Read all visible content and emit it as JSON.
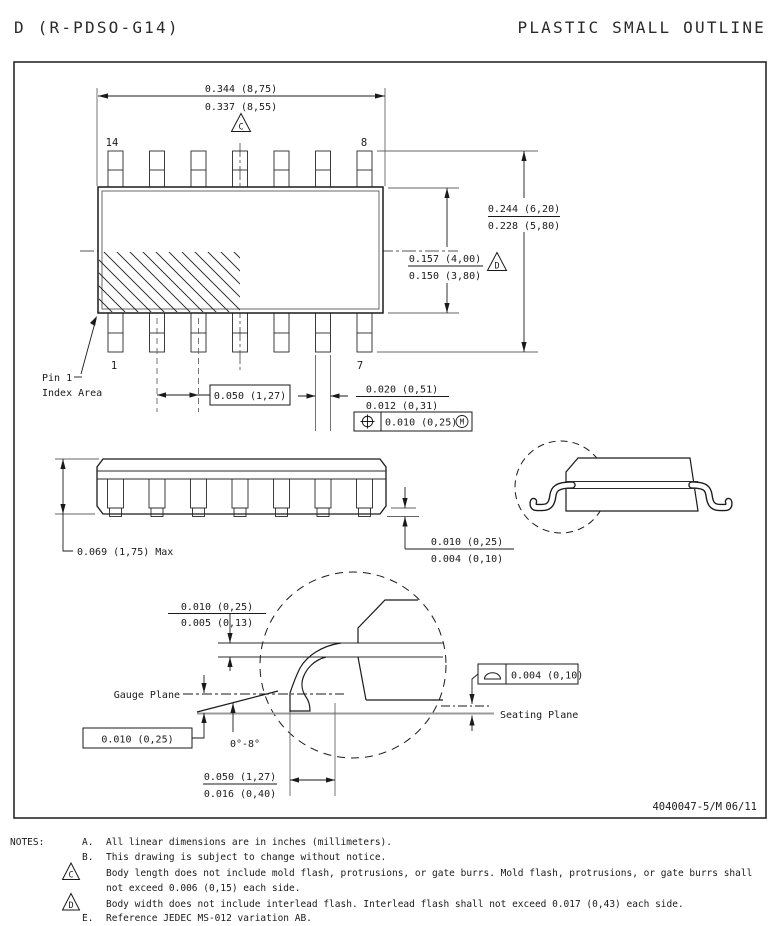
{
  "header": {
    "left_title": "D (R-PDSO-G14)",
    "right_title": "PLASTIC SMALL OUTLINE"
  },
  "footer": {
    "doc_number": "4040047-5/M",
    "date": "06/11"
  },
  "top_view": {
    "pin_label_14": "14",
    "pin_label_8": "8",
    "pin_label_1": "1",
    "pin_label_7": "7",
    "pin1_index_line1": "Pin 1",
    "pin1_index_line2": "Index Area",
    "dim_length": {
      "num": "0.344 (8,75)",
      "den": "0.337 (8,55)"
    },
    "dim_overall": {
      "num": "0.244 (6,20)",
      "den": "0.228 (5,80)"
    },
    "dim_body": {
      "num": "0.157 (4,00)",
      "den": "0.150 (3,80)"
    },
    "dim_pitch": "0.050 (1,27)",
    "dim_lead_width": {
      "num": "0.020 (0,51)",
      "den": "0.012 (0,31)"
    },
    "position_tolerance": {
      "value": "0.010 (0,25)",
      "modifier": "M"
    },
    "flag_c": "C",
    "flag_d": "D"
  },
  "side_view": {
    "dim_height": "0.069 (1,75) Max",
    "dim_standoff": {
      "num": "0.010 (0,25)",
      "den": "0.004 (0,10)"
    }
  },
  "detail_view": {
    "dim_thickness": {
      "num": "0.010 (0,25)",
      "den": "0.005 (0,13)"
    },
    "gauge_plane_label": "Gauge Plane",
    "dim_gauge_offset": "0.010 (0,25)",
    "angle": "0°-8°",
    "dim_foot": {
      "num": "0.050 (1,27)",
      "den": "0.016 (0,40)"
    },
    "flatness_value": "0.004 (0,10)",
    "seating_plane_label": "Seating Plane"
  },
  "notes": {
    "label": "NOTES:",
    "a_label": "A.",
    "a_text": "All linear dimensions are in inches (millimeters).",
    "b_label": "B.",
    "b_text": "This drawing is subject to change without notice.",
    "c_flag": "C",
    "c_text_line1": "Body length does not include mold flash, protrusions, or gate burrs.  Mold flash, protrusions, or gate burrs shall",
    "c_text_line2": "not exceed 0.006 (0,15) each side.",
    "d_flag": "D",
    "d_text": "Body width does not include interlead flash.  Interlead flash shall not exceed 0.017 (0,43) each side.",
    "e_label": "E.",
    "e_text": "Reference JEDEC MS-012 variation AB."
  }
}
